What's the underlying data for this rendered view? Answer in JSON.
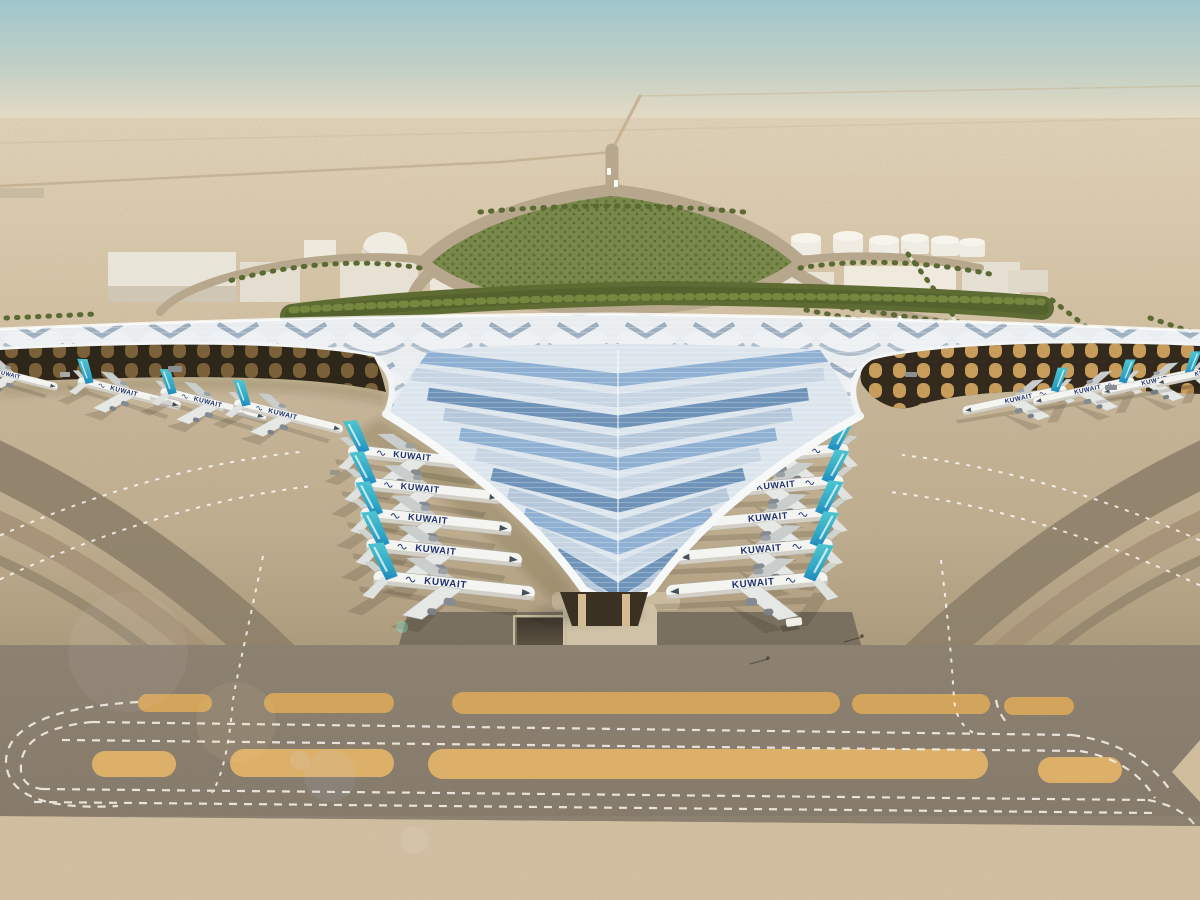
{
  "scene": {
    "description": "Aerial architectural rendering of a desert airport terminal with a winged solar roof",
    "airline_label": "KUWAIT",
    "aircraft_visible": 18,
    "aircraft_at_left_pier": 5,
    "aircraft_at_right_pier": 5,
    "aircraft_under_left_wing": 4,
    "aircraft_under_right_wing": 4,
    "ground_vehicle": "white van on apron",
    "markings": {
      "taxi_guidelines": "white dashed",
      "parallel_taxi_lanes": 2
    },
    "colors": {
      "sky_top": "#9fc6cb",
      "sky_horizon": "#e8dcc4",
      "desert": "#dfcfb2",
      "apron_concrete": "#c9b795",
      "taxiway_asphalt": "#85796a",
      "island_tan": "#d2a45c",
      "island_tan_bright": "#ddb06a",
      "sand_strip": "#d7c3a5",
      "roof_light": "#e9edf0",
      "solar_panel_blue": "#7fa2c6",
      "tail_teal": "#3fc0c9",
      "tail_blue": "#1d7fba",
      "airline_text_navy": "#20336f",
      "hedge_green": "#5e6c34",
      "facade_amber": "#d8a961"
    }
  }
}
